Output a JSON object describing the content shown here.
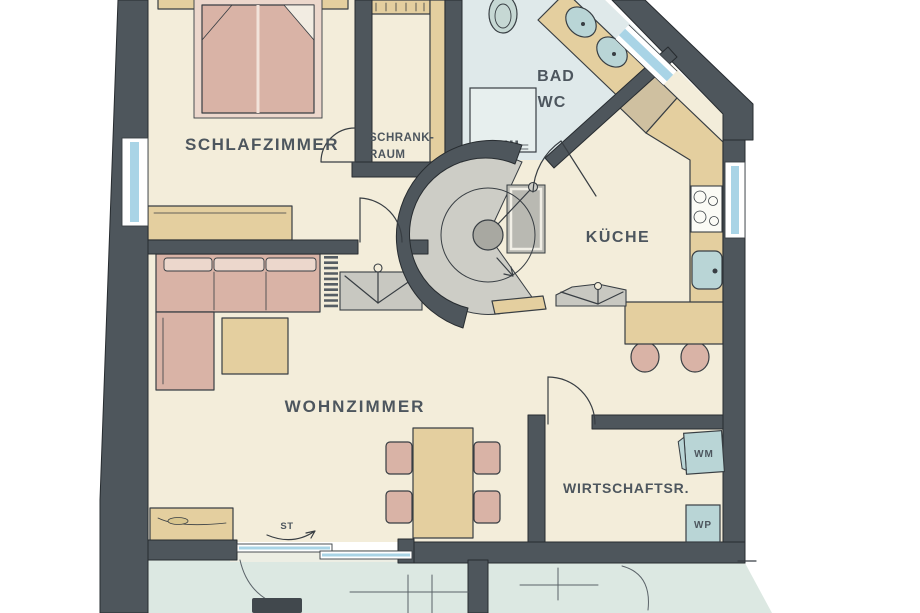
{
  "rooms": {
    "schlafzimmer": {
      "label": "SCHLAFZIMMER"
    },
    "schrankraum": {
      "line1": "SCHRANK-",
      "line2": "RAUM"
    },
    "bad": {
      "line1": "BAD",
      "line2": "WC"
    },
    "kueche": {
      "label": "KÜCHE"
    },
    "wohnzimmer": {
      "label": "WOHNZIMMER"
    },
    "wirtschaftsraum": {
      "label": "WIRTSCHAFTSR."
    }
  },
  "appliances": {
    "wm": "WM",
    "wp": "WP"
  },
  "annotations": {
    "st": "ST"
  },
  "colors": {
    "wall": "#4e565c",
    "floor": "#f3edda",
    "bath_floor": "#dfe9ea",
    "wood": "#e4cf9f",
    "wood_dark": "#cfc0a0",
    "upholstery": "#d9b3a6",
    "upholstery_light": "#ecd7cc",
    "appliance_blue": "#b9d5d6",
    "gray_furniture": "#c8c8c1",
    "window_glass": "#a9d4e6",
    "terrace": "#dce8e2",
    "ink": "#383e43",
    "label_text": "#4d565e"
  }
}
